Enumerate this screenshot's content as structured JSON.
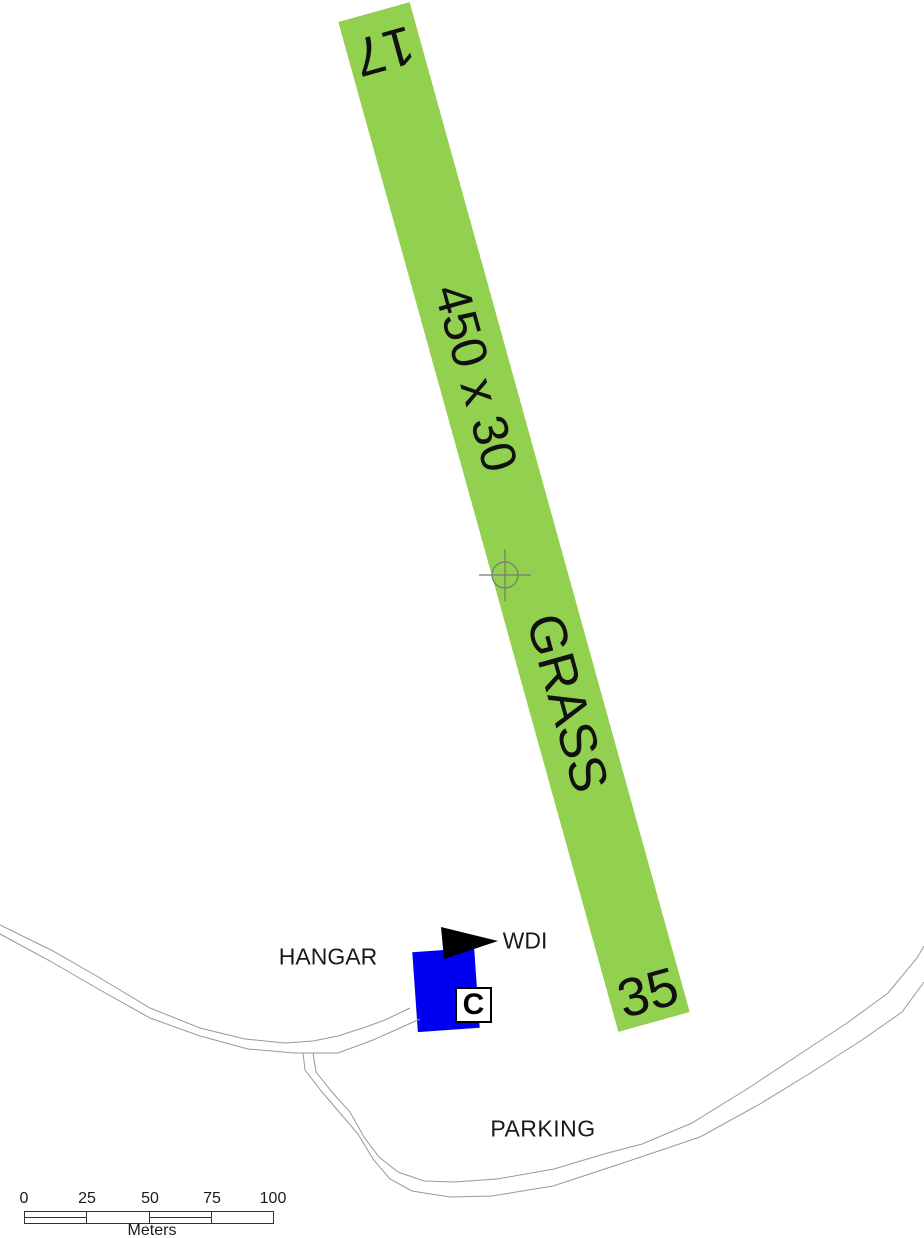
{
  "map": {
    "background_color": "#ffffff",
    "runway": {
      "end_label_north": "17",
      "end_label_south": "35",
      "size_label": "450 x 30",
      "surface_label": "GRASS",
      "color": "#92d050",
      "reference_point_icon": "crosshair"
    },
    "hangar": {
      "label": "HANGAR",
      "building_color": "#0000f0",
      "code_label": "C"
    },
    "wind_indicator": {
      "label": "WDI",
      "icon": "black-pennant-flag"
    },
    "parking": {
      "label": "PARKING"
    },
    "scale_bar": {
      "ticks": [
        "0",
        "25",
        "50",
        "75",
        "100"
      ],
      "unit": "Meters"
    }
  }
}
